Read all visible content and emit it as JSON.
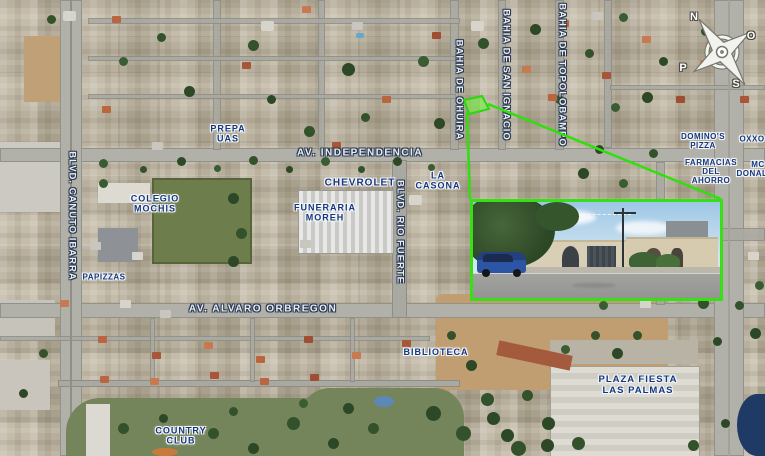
{
  "map": {
    "compass": {
      "north": "N",
      "east": "O",
      "south": "S",
      "west": "P"
    },
    "streets": [
      {
        "name": "AV. INDEPENDENCIA",
        "orientation": "horizontal"
      },
      {
        "name": "AV. ALVARO ORBREGON",
        "orientation": "horizontal"
      },
      {
        "name": "BLVD. CANUTO IBARRA",
        "orientation": "vertical"
      },
      {
        "name": "BLVD. RIO FUERTE",
        "orientation": "vertical"
      },
      {
        "name": "BAHIA DE OHUIRA",
        "orientation": "vertical"
      },
      {
        "name": "BAHIA DE SAN IGNACIO",
        "orientation": "vertical"
      },
      {
        "name": "BAHIA DE TOPOLOBAMPO",
        "orientation": "vertical"
      }
    ],
    "pois": [
      {
        "lines": [
          "PREPA",
          "UAS"
        ]
      },
      {
        "lines": [
          "COLEGIO",
          "MOCHIS"
        ]
      },
      {
        "lines": [
          "CHEVROLET"
        ]
      },
      {
        "lines": [
          "FUNERARIA",
          "MOREH"
        ]
      },
      {
        "lines": [
          "LA",
          "CASONA"
        ]
      },
      {
        "lines": [
          "PAPIZZAS"
        ]
      },
      {
        "lines": [
          "BIBLIOTECA"
        ]
      },
      {
        "lines": [
          "PLAZA FIESTA",
          "LAS PALMAS"
        ]
      },
      {
        "lines": [
          "COUNTRY",
          "CLUB"
        ]
      },
      {
        "lines": [
          "DOMINO'S",
          "PIZZA"
        ]
      },
      {
        "lines": [
          "OXXO"
        ]
      },
      {
        "lines": [
          "FARMACIAS",
          "DEL",
          "AHORRO"
        ]
      },
      {
        "lines": [
          "MC",
          "DONALDS"
        ]
      }
    ],
    "highlight_color": "#35e114",
    "label_color": "#16377e",
    "street_label_color": "#e9eef5"
  }
}
